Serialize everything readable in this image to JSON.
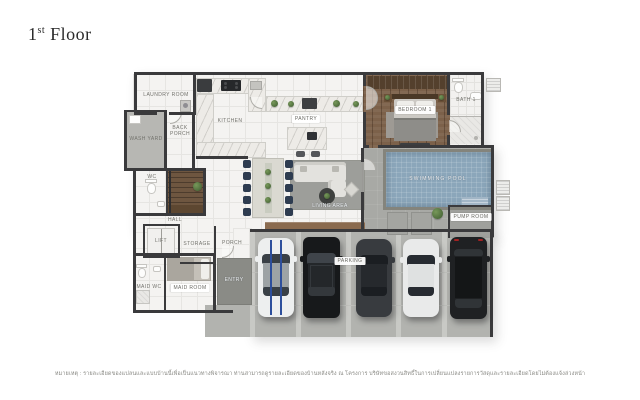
{
  "title": {
    "number": "1",
    "ordinal": "st",
    "word": "Floor"
  },
  "plan": {
    "labels": {
      "laundry_room": "LAUNDRY ROOM",
      "kitchen": "KITCHEN",
      "wash_yard": "WASH YARD",
      "back_porch": "BACK PORCH",
      "wc": "WC",
      "hall": "HALL",
      "lift": "LIFT",
      "storage": "STORAGE",
      "porch": "PORCH",
      "maid_wc": "MAID WC",
      "maid_room": "MAID ROOM",
      "entry": "ENTRY",
      "pantry": "PANTRY",
      "living_area": "LIVING AREA",
      "bedroom_1": "BEDROOM 1",
      "bath_1": "BATH 1",
      "swimming_pool": "SWIMMING POOL",
      "pump_room": "PUMP ROOM",
      "parking": "PARKING"
    },
    "colors": {
      "wall": "#3a3a3c",
      "tile_floor": "#f4f3f1",
      "pool_water": "#8ba6ba",
      "deck": "#a8a9a5",
      "concrete": "#b2b3af",
      "wood_floor": "#7c614a",
      "racing_stripe_blue": "#2d4f9c",
      "plant_green": "#4e7040"
    }
  },
  "footnote": "หมายเหตุ : รายละเอียดของแปลนและแบบบ้านนี้เพื่อเป็นแนวทางพิจารณา ท่านสามารถดูรายละเอียดของบ้านหลังจริง ณ โครงการ บริษัทขอสงวนสิทธิ์ในการเปลี่ยนแปลงรายการวัสดุและรายละเอียดโดยไม่ต้องแจ้งล่วงหน้า"
}
